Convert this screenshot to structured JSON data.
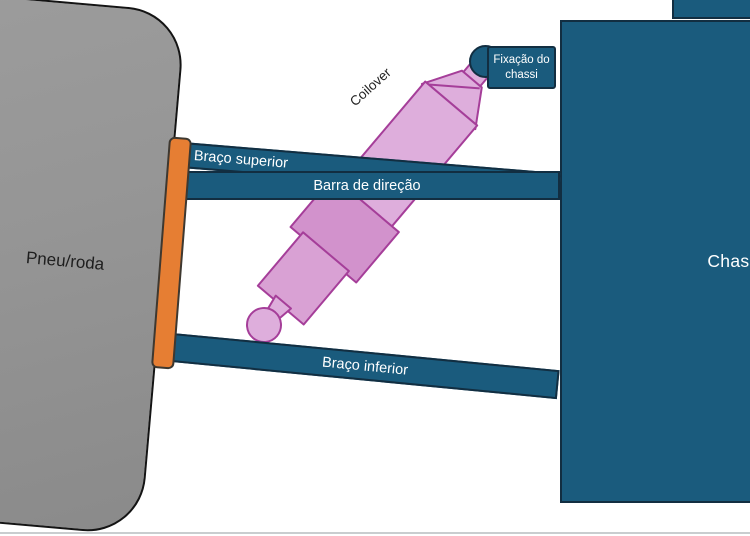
{
  "labels": {
    "wheel": "Pneu/roda",
    "chassis": "Chassi",
    "upper_arm": "Braço superior",
    "steering_bar": "Barra de direção",
    "lower_arm": "Braço inferior",
    "coilover": "Coilover",
    "chassis_mount": "Fixação do chassi"
  },
  "colors": {
    "bar_teal": "#1A5B7D",
    "teal_outline": "#122E41",
    "orange": "#E67E33",
    "orange_outline": "#3E3830",
    "wheel_gray": "#959595",
    "wheel_gray_light": "#9C9C9C",
    "wheel_gray_dark": "#8A8A8A",
    "wheel_outline": "#141414",
    "pink_light": "#DEAEDC",
    "pink_mid": "#D292CC",
    "pink_mid_light": "#D9A1D4",
    "pink_outline": "#A53E99",
    "label_text": "#FFFFFF",
    "dark_text": "#1E1E1E",
    "canvas_edge": "#C9CDCF"
  }
}
